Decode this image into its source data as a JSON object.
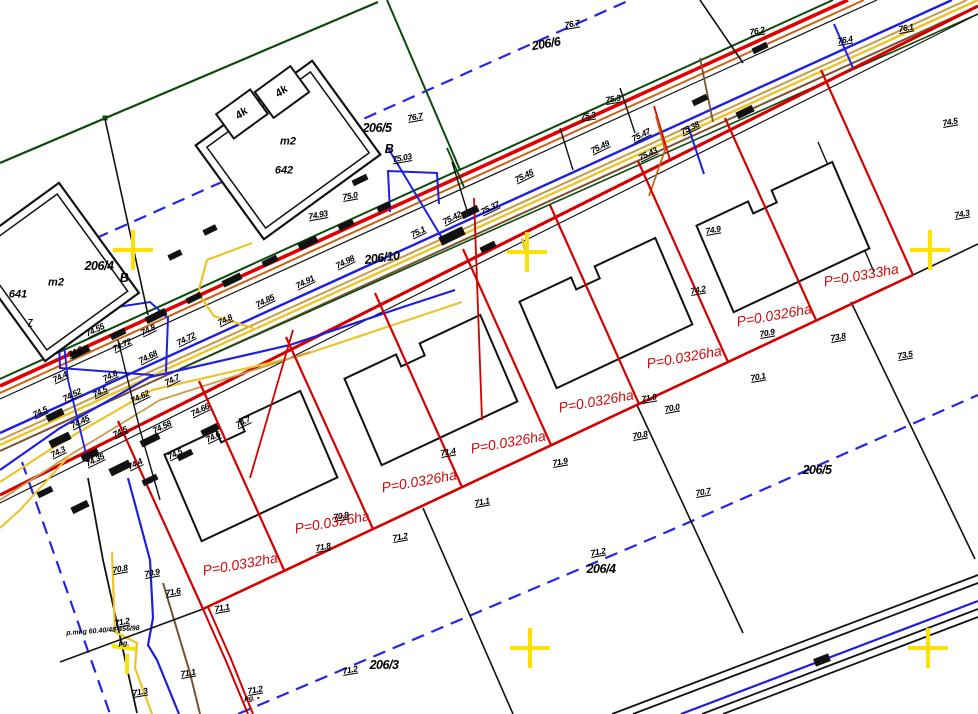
{
  "map": {
    "type": "cadastral-utility-survey-plan",
    "colors": {
      "parcel_boundary_red": "#d40000",
      "utility_blue": "#1e1ee0",
      "dashed_boundary_blue": "#2626e8",
      "utility_yellow": "#edc427",
      "grid_cross_yellow": "#ffe100",
      "boundary_green": "#0c4a0c",
      "utility_orange": "#c86414",
      "utility_tan": "#c89b4a",
      "utility_brown": "#7a5230",
      "linework_black": "#111111"
    },
    "grid_crosses": [
      {
        "x": 133,
        "y": 250
      },
      {
        "x": 527,
        "y": 252
      },
      {
        "x": 930,
        "y": 250
      },
      {
        "x": 530,
        "y": 648
      },
      {
        "x": 928,
        "y": 648
      }
    ],
    "labels": {
      "parcels": [
        {
          "t": "206/5",
          "x": 377,
          "y": 128
        },
        {
          "t": "B",
          "x": 389,
          "y": 149
        },
        {
          "t": "206/6",
          "x": 546,
          "y": 44,
          "r": -10
        },
        {
          "t": "206/10",
          "x": 382,
          "y": 258,
          "r": -8
        },
        {
          "t": "206/4",
          "x": 99,
          "y": 266
        },
        {
          "t": "B",
          "x": 124,
          "y": 278
        },
        {
          "t": "206/5",
          "x": 817,
          "y": 470
        },
        {
          "t": "206/4",
          "x": 601,
          "y": 569
        },
        {
          "t": "206/3",
          "x": 384,
          "y": 665
        }
      ],
      "buildings": [
        {
          "t": "m2",
          "x": 288,
          "y": 142,
          "r": 0
        },
        {
          "t": "642",
          "x": 284,
          "y": 171,
          "r": 0
        },
        {
          "t": "m2",
          "x": 56,
          "y": 283,
          "r": 0
        },
        {
          "t": "641",
          "x": 18,
          "y": 295,
          "r": 0
        },
        {
          "t": "4k",
          "x": 242,
          "y": 114,
          "r": -36
        },
        {
          "t": "4k",
          "x": 282,
          "y": 92,
          "r": -36
        }
      ],
      "areas": [
        {
          "t": "P=0.0332ha",
          "x": 240,
          "y": 564,
          "r": -10
        },
        {
          "t": "P=0.0326ha",
          "x": 332,
          "y": 522,
          "r": -10
        },
        {
          "t": "P=0.0326ha",
          "x": 419,
          "y": 481,
          "r": -10
        },
        {
          "t": "P=0.0326ha",
          "x": 508,
          "y": 442,
          "r": -10
        },
        {
          "t": "P=0.0326ha",
          "x": 596,
          "y": 401,
          "r": -10
        },
        {
          "t": "P=0.0326ha",
          "x": 684,
          "y": 357,
          "r": -10
        },
        {
          "t": "P=0.0326ha",
          "x": 774,
          "y": 315,
          "r": -10
        },
        {
          "t": "P=0.0333ha",
          "x": 861,
          "y": 275,
          "r": -10
        }
      ],
      "spots": [
        {
          "t": "76.7",
          "x": 572,
          "y": 24
        },
        {
          "t": "76.7",
          "x": 415,
          "y": 117
        },
        {
          "t": "76.2",
          "x": 757,
          "y": 31
        },
        {
          "t": "76.4",
          "x": 845,
          "y": 40
        },
        {
          "t": "76.1",
          "x": 906,
          "y": 28
        },
        {
          "t": "74.5",
          "x": 950,
          "y": 122
        },
        {
          "t": "75.3",
          "x": 613,
          "y": 99
        },
        {
          "t": "75.3",
          "x": 588,
          "y": 116
        },
        {
          "t": "75.47",
          "x": 641,
          "y": 135,
          "r": -26
        },
        {
          "t": "75.49",
          "x": 600,
          "y": 147,
          "r": -26
        },
        {
          "t": "75.43",
          "x": 648,
          "y": 154,
          "r": -26
        },
        {
          "t": "75.38",
          "x": 690,
          "y": 128,
          "r": -26
        },
        {
          "t": "75.45",
          "x": 524,
          "y": 176,
          "r": -26
        },
        {
          "t": "75.37",
          "x": 490,
          "y": 208,
          "r": -26
        },
        {
          "t": "75.42",
          "x": 452,
          "y": 218,
          "r": -26
        },
        {
          "t": "75.1",
          "x": 418,
          "y": 232,
          "r": -26
        },
        {
          "t": "75.03",
          "x": 402,
          "y": 158
        },
        {
          "t": "75.0",
          "x": 350,
          "y": 196
        },
        {
          "t": "74.93",
          "x": 318,
          "y": 215
        },
        {
          "t": "74.98",
          "x": 345,
          "y": 262,
          "r": -26
        },
        {
          "t": "74.91",
          "x": 305,
          "y": 282,
          "r": -26
        },
        {
          "t": "74.85",
          "x": 265,
          "y": 301,
          "r": -26
        },
        {
          "t": "74.8",
          "x": 225,
          "y": 320,
          "r": -26
        },
        {
          "t": "74.72",
          "x": 186,
          "y": 339,
          "r": -26
        },
        {
          "t": "74.68",
          "x": 148,
          "y": 357,
          "r": -26
        },
        {
          "t": "74.6",
          "x": 110,
          "y": 376,
          "r": -26
        },
        {
          "t": "74.52",
          "x": 72,
          "y": 395,
          "r": -26
        },
        {
          "t": "74.5",
          "x": 40,
          "y": 412,
          "r": -26
        },
        {
          "t": "74.9",
          "x": 713,
          "y": 230
        },
        {
          "t": "74.2",
          "x": 698,
          "y": 290
        },
        {
          "t": "73.8",
          "x": 838,
          "y": 337
        },
        {
          "t": "73.5",
          "x": 905,
          "y": 355
        },
        {
          "t": "74.3",
          "x": 962,
          "y": 214
        },
        {
          "t": "71.8",
          "x": 323,
          "y": 547
        },
        {
          "t": "71.2",
          "x": 400,
          "y": 537
        },
        {
          "t": "71.1",
          "x": 482,
          "y": 502
        },
        {
          "t": "71.9",
          "x": 560,
          "y": 462
        },
        {
          "t": "71.0",
          "x": 649,
          "y": 398
        },
        {
          "t": "70.9",
          "x": 341,
          "y": 516
        },
        {
          "t": "70.0",
          "x": 672,
          "y": 408
        },
        {
          "t": "70.8",
          "x": 640,
          "y": 435
        },
        {
          "t": "70.7",
          "x": 703,
          "y": 492
        },
        {
          "t": "70.1",
          "x": 758,
          "y": 377
        },
        {
          "t": "70.9",
          "x": 767,
          "y": 333
        },
        {
          "t": "71.4",
          "x": 448,
          "y": 452
        },
        {
          "t": "71.2",
          "x": 350,
          "y": 670
        },
        {
          "t": "71.2",
          "x": 598,
          "y": 552
        },
        {
          "t": "71.1",
          "x": 222,
          "y": 608
        },
        {
          "t": "71.6",
          "x": 173,
          "y": 592
        },
        {
          "t": "71.2",
          "x": 122,
          "y": 622
        },
        {
          "t": "71.3",
          "x": 140,
          "y": 692
        },
        {
          "t": "71.1",
          "x": 188,
          "y": 673
        },
        {
          "t": "71.2",
          "x": 255,
          "y": 690
        },
        {
          "t": "70.8",
          "x": 120,
          "y": 569
        },
        {
          "t": "70.9",
          "x": 152,
          "y": 573
        },
        {
          "t": "74.55",
          "x": 95,
          "y": 330,
          "r": -26
        },
        {
          "t": "74.6",
          "x": 75,
          "y": 352,
          "r": -26
        },
        {
          "t": "74.72",
          "x": 122,
          "y": 345,
          "r": -26
        },
        {
          "t": "74.8",
          "x": 148,
          "y": 330,
          "r": -26
        },
        {
          "t": "74.4",
          "x": 60,
          "y": 377,
          "r": -26
        },
        {
          "t": "74.5",
          "x": 100,
          "y": 392,
          "r": -26
        },
        {
          "t": "74.62",
          "x": 140,
          "y": 397,
          "r": -26
        },
        {
          "t": "74.7",
          "x": 172,
          "y": 380,
          "r": -26
        },
        {
          "t": "74.45",
          "x": 80,
          "y": 422,
          "r": -26
        },
        {
          "t": "74.5",
          "x": 120,
          "y": 432,
          "r": -26
        },
        {
          "t": "74.58",
          "x": 162,
          "y": 427,
          "r": -26
        },
        {
          "t": "74.66",
          "x": 200,
          "y": 410,
          "r": -26
        },
        {
          "t": "74.3",
          "x": 58,
          "y": 452,
          "r": -26
        },
        {
          "t": "74.35",
          "x": 95,
          "y": 460,
          "r": -26
        },
        {
          "t": "74.4",
          "x": 135,
          "y": 464,
          "r": -26
        },
        {
          "t": "74.5",
          "x": 175,
          "y": 454,
          "r": -26
        },
        {
          "t": "74.6",
          "x": 213,
          "y": 437,
          "r": -26
        },
        {
          "t": "74.7",
          "x": 243,
          "y": 422,
          "r": -26
        },
        {
          "t": "7",
          "x": 30,
          "y": 322,
          "r": 0
        }
      ],
      "codes": [
        {
          "t": "p.mł.g 60.40/48-456/98",
          "x": 103,
          "y": 631,
          "r": -4
        },
        {
          "t": "pg.",
          "x": 124,
          "y": 644,
          "r": 0
        },
        {
          "t": "pg. •",
          "x": 252,
          "y": 699,
          "r": 0
        }
      ]
    }
  }
}
